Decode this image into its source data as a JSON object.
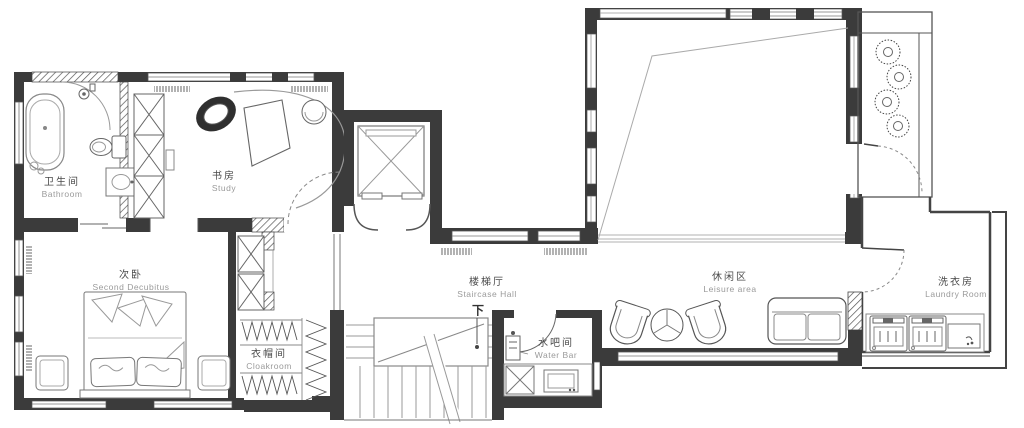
{
  "plan": {
    "type": "residential-floor-plan",
    "rooms": [
      {
        "id": "bathroom",
        "zh": "卫生间",
        "en": "Bathroom"
      },
      {
        "id": "study",
        "zh": "书房",
        "en": "Study"
      },
      {
        "id": "second-bedroom",
        "zh": "次卧",
        "en": "Second Decubitus"
      },
      {
        "id": "cloakroom",
        "zh": "衣帽间",
        "en": "Cloakroom"
      },
      {
        "id": "staircase-hall",
        "zh": "楼梯厅",
        "en": "Staircase Hall"
      },
      {
        "id": "water-bar",
        "zh": "水吧间",
        "en": "Water Bar"
      },
      {
        "id": "leisure-area",
        "zh": "休闲区",
        "en": "Leisure area"
      },
      {
        "id": "laundry-room",
        "zh": "洗衣房",
        "en": "Laundry Room"
      }
    ],
    "annotations": {
      "stair_direction": "下"
    },
    "colors": {
      "wall": "#3b3b3b",
      "furniture_line": "#8a8a8a",
      "label_zh": "#4a4a4a",
      "label_en": "#9a9a9a",
      "background": "#ffffff"
    }
  }
}
